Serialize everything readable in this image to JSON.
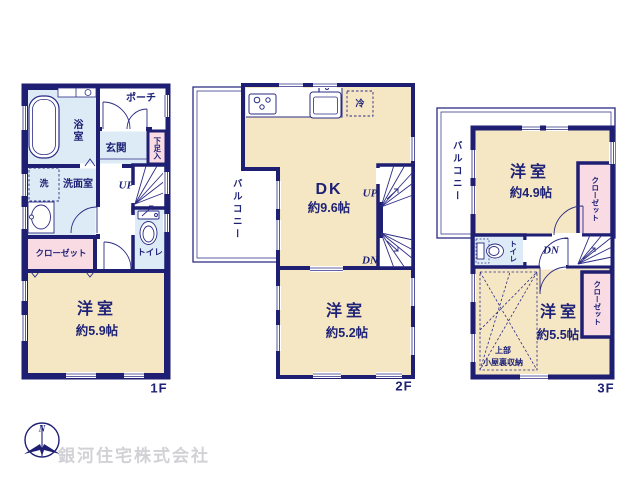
{
  "branding": {
    "company_name": "銀河住宅株式会社",
    "compass_north": "N"
  },
  "colors": {
    "wall_navy": "#1e1e73",
    "line_navy": "#2b2b85",
    "text_navy": "#1e2277",
    "room_cream": "#f6e7c4",
    "wet_area_blue": "#dcebf5",
    "closet_pink": "#f9dce3",
    "brand_gray": "#d2d2d6"
  },
  "floor_1f": {
    "floor_label": "1F",
    "porch": "ポーチ",
    "bathroom": "浴室",
    "entrance": "玄関",
    "shoe_cabinet": "下足入",
    "washer": "洗",
    "washroom": "洗面室",
    "stairs_up": "UP",
    "toilet": "トイレ",
    "closet": "クローゼット",
    "bedroom_name": "洋室",
    "bedroom_size": "約5.9帖"
  },
  "floor_2f": {
    "floor_label": "2F",
    "balcony": "バルコニー",
    "refrigerator": "冷",
    "dk_name": "DK",
    "dk_size": "約9.6帖",
    "stairs_up": "UP",
    "stairs_down": "DN",
    "bedroom_name": "洋室",
    "bedroom_size": "約5.2帖"
  },
  "floor_3f": {
    "floor_label": "3F",
    "balcony": "バルコニー",
    "bedroom1_name": "洋室",
    "bedroom1_size": "約4.9帖",
    "closet_upper": "クローゼット",
    "toilet": "トイレ",
    "stairs_down": "DN",
    "bedroom2_name": "洋室",
    "bedroom2_size": "約5.5帖",
    "closet_lower": "クローゼット",
    "attic_note_line1": "上部",
    "attic_note_line2": "小屋裏収納"
  }
}
